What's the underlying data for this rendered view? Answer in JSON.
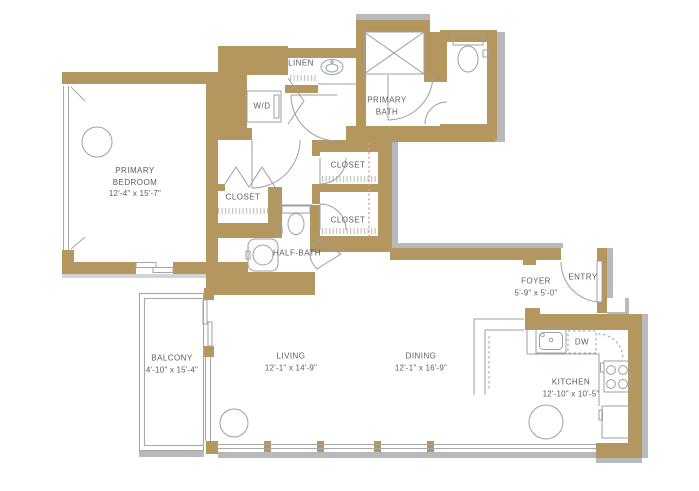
{
  "floorplan": {
    "type": "apartment-floor-plan",
    "colors": {
      "wall": "#b4975e",
      "shadow": "#b7babb",
      "fixture_line": "#9aa0a4",
      "text": "#595d5f",
      "closet_rod_dashed": "#dd9b97",
      "background": "#ffffff"
    },
    "rooms": {
      "primary_bedroom": {
        "line1": "PRIMARY",
        "line2": "BEDROOM",
        "dims": "12'-4\" x 15'-7\""
      },
      "primary_bath": {
        "line1": "PRIMARY",
        "line2": "BATH"
      },
      "linen": {
        "label": "LINEN"
      },
      "wd": {
        "label": "W/D"
      },
      "closet_hall_upper": {
        "label": "CLOSET"
      },
      "closet_hall_lower": {
        "label": "CLOSET"
      },
      "closet_bedroom": {
        "label": "CLOSET"
      },
      "half_bath": {
        "label": "HALF-BATH"
      },
      "foyer": {
        "label": "FOYER",
        "dims": "5'-9\" x 5'-0\""
      },
      "entry": {
        "label": "ENTRY"
      },
      "living": {
        "label": "LIVING",
        "dims": "12'-1\" x 14'-9\""
      },
      "dining": {
        "label": "DINING",
        "dims": "12'-1\" x 16'-9\""
      },
      "kitchen": {
        "label": "KITCHEN",
        "dims": "12'-10\" x 10'-5\""
      },
      "balcony": {
        "label": "BALCONY",
        "dims": "4'-10\" x 15'-4\""
      },
      "dishwasher": {
        "label": "DW"
      }
    }
  }
}
